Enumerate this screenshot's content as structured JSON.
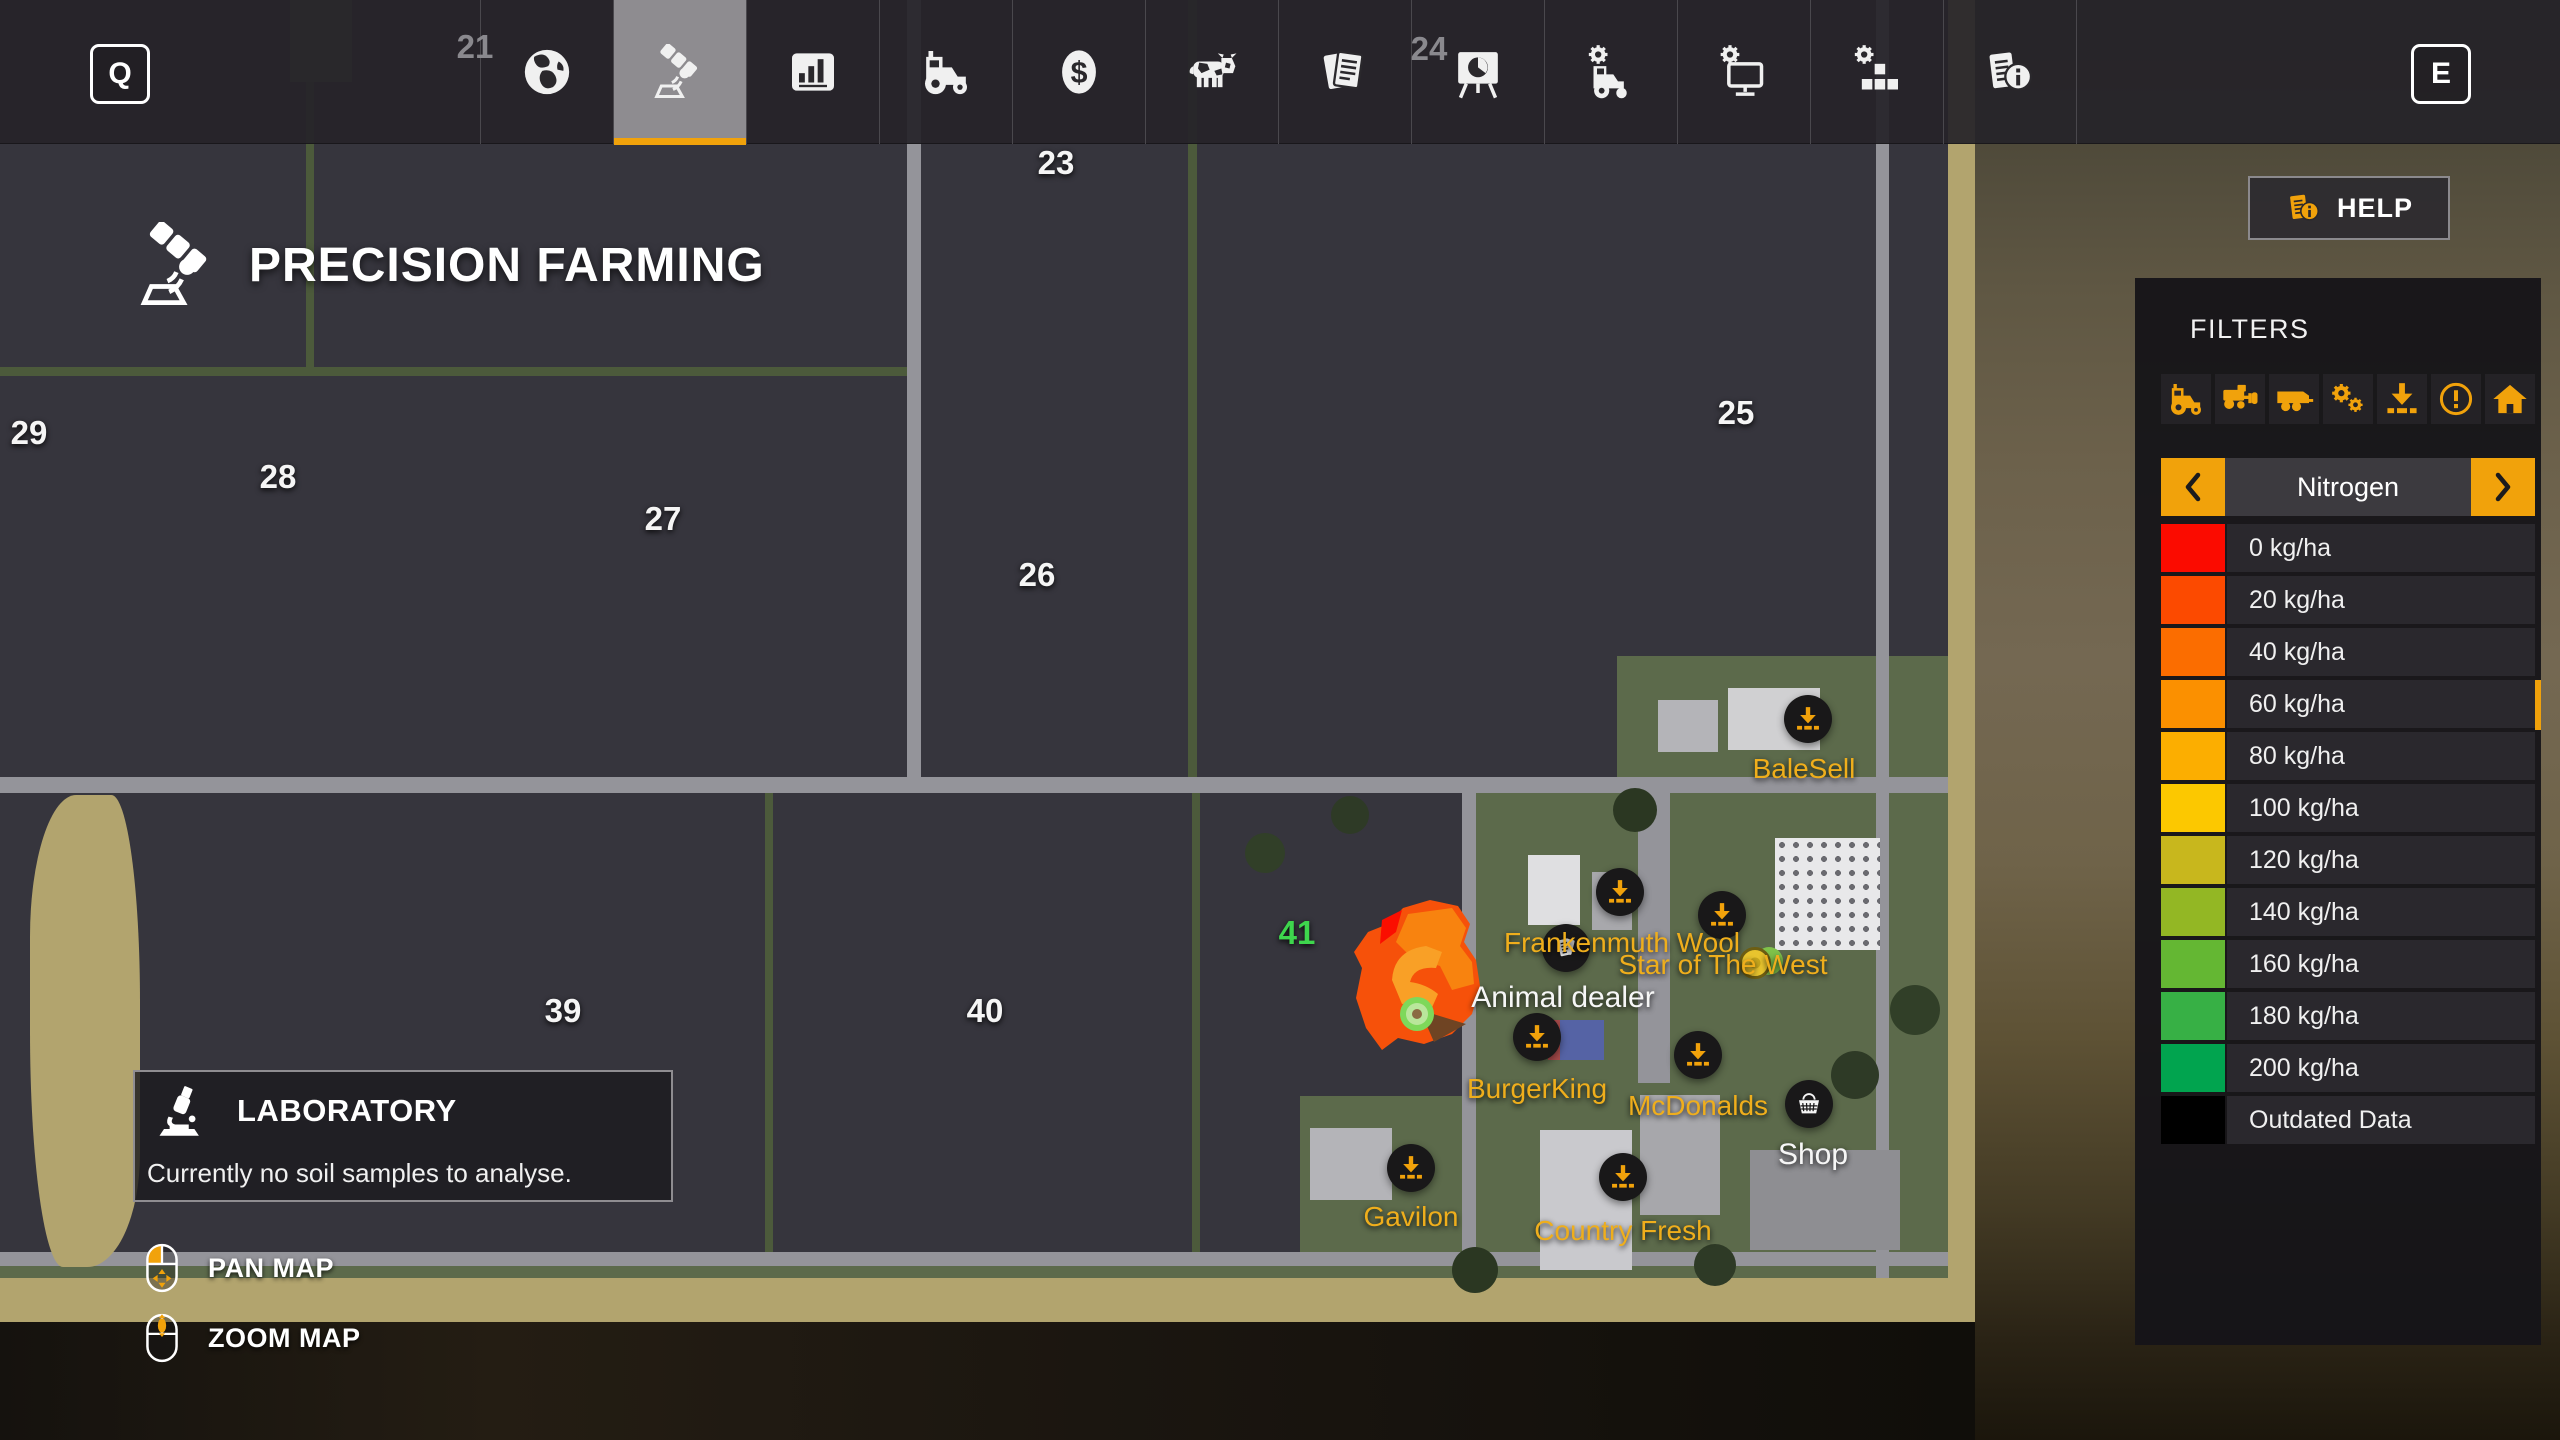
{
  "colors": {
    "accent": "#f1a20b",
    "field_number": "#f5f5f5",
    "field_number_highlight": "#3ed64d",
    "poi_label": "#efae1c"
  },
  "top_bar": {
    "left_key_label": "Q",
    "right_key_label": "E",
    "tabs": [
      {
        "id": "map",
        "icon": "globe-icon",
        "selected": false
      },
      {
        "id": "precision-farming",
        "icon": "satellite-icon",
        "selected": true
      },
      {
        "id": "statistics",
        "icon": "bar-chart-icon",
        "selected": false
      },
      {
        "id": "vehicles",
        "icon": "tractor-icon",
        "selected": false
      },
      {
        "id": "finances",
        "icon": "dollar-icon",
        "selected": false
      },
      {
        "id": "animals",
        "icon": "cow-icon",
        "selected": false
      },
      {
        "id": "contracts",
        "icon": "documents-icon",
        "selected": false
      },
      {
        "id": "prices",
        "icon": "easel-chart-icon",
        "selected": false
      },
      {
        "id": "vehicle-settings",
        "icon": "tractor-gear-icon",
        "selected": false
      },
      {
        "id": "game-settings",
        "icon": "monitor-gear-icon",
        "selected": false
      },
      {
        "id": "general-settings",
        "icon": "blocks-gear-icon",
        "selected": false
      },
      {
        "id": "help",
        "icon": "info-doc-icon",
        "selected": false
      }
    ]
  },
  "title": {
    "label": "PRECISION FARMING",
    "icon": "satellite-icon"
  },
  "help_button": {
    "label": "HELP",
    "icon": "info-doc-icon"
  },
  "filters": {
    "title": "FILTERS",
    "icons": [
      "tractor-icon",
      "combine-icon",
      "trailer-icon",
      "gears-icon",
      "download-icon",
      "warning-icon",
      "house-icon"
    ],
    "selector": {
      "value": "Nitrogen"
    },
    "legend": [
      {
        "label": "0 kg/ha",
        "color": "#fb0b00"
      },
      {
        "label": "20 kg/ha",
        "color": "#fc4a00"
      },
      {
        "label": "40 kg/ha",
        "color": "#fb6d00"
      },
      {
        "label": "60 kg/ha",
        "color": "#fb9000"
      },
      {
        "label": "80 kg/ha",
        "color": "#fcae00"
      },
      {
        "label": "100 kg/ha",
        "color": "#fcc800"
      },
      {
        "label": "120 kg/ha",
        "color": "#c8b71d"
      },
      {
        "label": "140 kg/ha",
        "color": "#93b724"
      },
      {
        "label": "160 kg/ha",
        "color": "#64b733"
      },
      {
        "label": "180 kg/ha",
        "color": "#37b045"
      },
      {
        "label": "200 kg/ha",
        "color": "#01a44f"
      },
      {
        "label": "Outdated Data",
        "color": "#000000"
      }
    ]
  },
  "laboratory": {
    "title": "LABORATORY",
    "message": "Currently no soil samples to analyse.",
    "icon": "microscope-icon"
  },
  "map_controls": [
    {
      "label": "PAN MAP",
      "icon": "mouse-pan-icon"
    },
    {
      "label": "ZOOM MAP",
      "icon": "mouse-zoom-icon"
    }
  ],
  "map": {
    "field_numbers": [
      {
        "label": "21",
        "x": 475,
        "y": 47,
        "style": "dim"
      },
      {
        "label": "23",
        "x": 1056,
        "y": 163,
        "style": "normal"
      },
      {
        "label": "24",
        "x": 1429,
        "y": 49,
        "style": "dim"
      },
      {
        "label": "25",
        "x": 1736,
        "y": 413,
        "style": "normal"
      },
      {
        "label": "26",
        "x": 1037,
        "y": 575,
        "style": "normal"
      },
      {
        "label": "27",
        "x": 663,
        "y": 519,
        "style": "normal"
      },
      {
        "label": "28",
        "x": 278,
        "y": 477,
        "style": "normal"
      },
      {
        "label": "29",
        "x": 29,
        "y": 433,
        "style": "normal"
      },
      {
        "label": "39",
        "x": 563,
        "y": 1011,
        "style": "normal"
      },
      {
        "label": "40",
        "x": 985,
        "y": 1011,
        "style": "normal"
      },
      {
        "label": "41",
        "x": 1297,
        "y": 933,
        "style": "highlight"
      }
    ],
    "pois": [
      {
        "label": "BaleSell",
        "icon": "download-icon",
        "ix": 1808,
        "iy": 719,
        "lx": 1804,
        "ly": 769,
        "label_style": "orange"
      },
      {
        "label": "",
        "icon": "download-icon",
        "ix": 1620,
        "iy": 892
      },
      {
        "label": "",
        "icon": "download-icon",
        "ix": 1722,
        "iy": 915
      },
      {
        "label": "Frankenmuth Wool",
        "icon": "wool-icon",
        "ix": 1566,
        "iy": 948,
        "lx": 1622,
        "ly": 943,
        "label_style": "orange"
      },
      {
        "label": "Star of The West",
        "icon": "star-marker-icon",
        "ix": 1762,
        "iy": 963,
        "lx": 1723,
        "ly": 965,
        "label_style": "orange"
      },
      {
        "label": "Animal dealer",
        "icon": "none",
        "lx": 1563,
        "ly": 998,
        "label_style": "white"
      },
      {
        "label": "BurgerKing",
        "icon": "download-icon",
        "ix": 1537,
        "iy": 1037,
        "lx": 1537,
        "ly": 1089,
        "label_style": "orange"
      },
      {
        "label": "McDonalds",
        "icon": "download-icon",
        "ix": 1698,
        "iy": 1055,
        "lx": 1698,
        "ly": 1106,
        "label_style": "orange"
      },
      {
        "label": "Shop",
        "icon": "basket-icon",
        "ix": 1809,
        "iy": 1104,
        "lx": 1813,
        "ly": 1155,
        "label_style": "white"
      },
      {
        "label": "Gavilon",
        "icon": "download-icon",
        "ix": 1411,
        "iy": 1168,
        "lx": 1411,
        "ly": 1217,
        "label_style": "orange"
      },
      {
        "label": "Country Fresh",
        "icon": "download-icon",
        "ix": 1623,
        "iy": 1177,
        "lx": 1623,
        "ly": 1231,
        "label_style": "orange"
      }
    ]
  }
}
